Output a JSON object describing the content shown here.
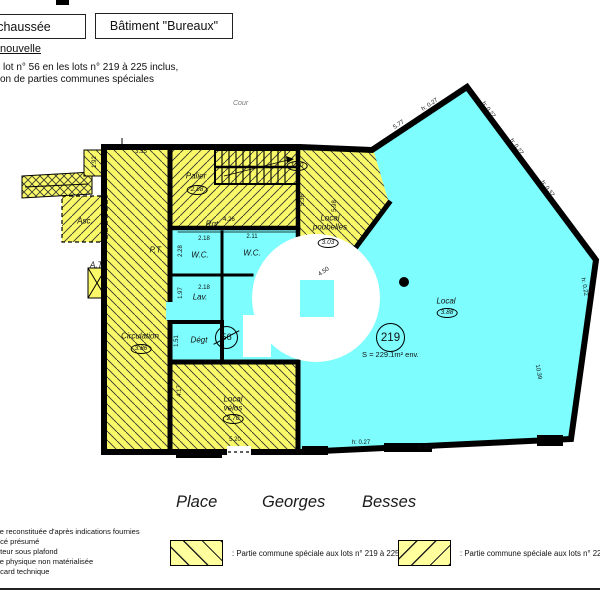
{
  "header": {
    "floor_box": "chaussée",
    "building_box": "Bâtiment \"Bureaux\"",
    "situation": "nouvelle",
    "line1": "lot n° 56 en les lots n° 219 à 225 inclus,",
    "line2": "on de parties communes spéciales"
  },
  "plan": {
    "cour": "Cour",
    "area": "S = 229.1m² env.",
    "lot_new": "219",
    "lot_old": "56",
    "rooms": [
      {
        "t": "Palier",
        "x": 196,
        "y": 176,
        "n": "room-label-palier"
      },
      {
        "t": "Rgt.",
        "x": 213,
        "y": 224,
        "n": "room-label-rgt"
      },
      {
        "t": "W.C.",
        "x": 200,
        "y": 255,
        "n": "room-label-wc-1"
      },
      {
        "t": "W.C.",
        "x": 252,
        "y": 253,
        "n": "room-label-wc-2"
      },
      {
        "t": "Lav.",
        "x": 200,
        "y": 297,
        "n": "room-label-lav"
      },
      {
        "t": "Dégt",
        "x": 199,
        "y": 340,
        "n": "room-label-degt"
      },
      {
        "t": "Circulation",
        "x": 140,
        "y": 336,
        "n": "room-label-circulation"
      },
      {
        "t": "Local",
        "x": 330,
        "y": 218,
        "n": "room-label-local-poubelles-1"
      },
      {
        "t": "poubelles",
        "x": 330,
        "y": 227,
        "n": "room-label-local-poubelles-2"
      },
      {
        "t": "Local",
        "x": 233,
        "y": 399,
        "n": "room-label-local-velos-1"
      },
      {
        "t": "vélos",
        "x": 233,
        "y": 408,
        "n": "room-label-local-velos-2"
      },
      {
        "t": "Local",
        "x": 446,
        "y": 301,
        "n": "room-label-local"
      },
      {
        "t": "Asc.",
        "x": 85,
        "y": 221,
        "n": "room-label-ascenseur"
      },
      {
        "t": "P.T.",
        "x": 156,
        "y": 250,
        "n": "room-label-pt"
      },
      {
        "t": "A.T.",
        "x": 97,
        "y": 265,
        "n": "room-label-at"
      }
    ],
    "ovals": [
      {
        "t": "2.88",
        "x": 197,
        "y": 190,
        "n": "height-oval-palier"
      },
      {
        "t": "1.90",
        "x": 297,
        "y": 166,
        "n": "height-oval-stairs"
      },
      {
        "t": "3.03",
        "x": 328,
        "y": 243,
        "n": "height-oval-poubelles"
      },
      {
        "t": "3.86",
        "x": 141,
        "y": 349,
        "n": "height-oval-circulation"
      },
      {
        "t": "2.70",
        "x": 233,
        "y": 419,
        "n": "height-oval-velos"
      },
      {
        "t": "3.88",
        "x": 447,
        "y": 313,
        "n": "height-oval-local"
      }
    ],
    "dims": [
      {
        "t": "3.55",
        "x": 141,
        "y": 152,
        "r": 0
      },
      {
        "t": "1.92",
        "x": 95,
        "y": 162,
        "r": -90
      },
      {
        "t": "4.26",
        "x": 229,
        "y": 220,
        "r": 0
      },
      {
        "t": "2.18",
        "x": 204,
        "y": 239,
        "r": 0
      },
      {
        "t": "2.11",
        "x": 252,
        "y": 237,
        "r": 0
      },
      {
        "t": "2.18",
        "x": 204,
        "y": 288,
        "r": 0
      },
      {
        "t": "2.28",
        "x": 181,
        "y": 251,
        "r": -90
      },
      {
        "t": "1.97",
        "x": 181,
        "y": 293,
        "r": -90
      },
      {
        "t": "1.51",
        "x": 177,
        "y": 341,
        "r": -90
      },
      {
        "t": "4.17",
        "x": 180,
        "y": 391,
        "r": -90
      },
      {
        "t": "5.20",
        "x": 235,
        "y": 440,
        "r": 0
      },
      {
        "t": "5.36",
        "x": 303,
        "y": 200,
        "r": -90
      },
      {
        "t": "5.98",
        "x": 335,
        "y": 206,
        "r": -90
      },
      {
        "t": "4.50",
        "x": 324,
        "y": 272,
        "r": -35
      },
      {
        "t": "5.77",
        "x": 399,
        "y": 125,
        "r": -33
      },
      {
        "t": "h: 0.27",
        "x": 430,
        "y": 105,
        "r": -33
      },
      {
        "t": "h: 0.27",
        "x": 488,
        "y": 110,
        "r": 53
      },
      {
        "t": "h: 0.27",
        "x": 516,
        "y": 147,
        "r": 53
      },
      {
        "t": "h: 0.37",
        "x": 547,
        "y": 189,
        "r": 53
      },
      {
        "t": "h: 0.27",
        "x": 573,
        "y": 231,
        "r": 53
      },
      {
        "t": "h: 0.22",
        "x": 584,
        "y": 287,
        "r": 80
      },
      {
        "t": "10.39",
        "x": 538,
        "y": 372,
        "r": 80
      },
      {
        "t": "h: 0.27",
        "x": 361,
        "y": 443,
        "r": 0
      },
      {
        "t": "h: 0.27",
        "x": 427,
        "y": 448,
        "r": 0
      }
    ]
  },
  "street": [
    "Place",
    "Georges",
    "Besses"
  ],
  "legend": {
    "notes": [
      "ite reconstituée d'après indications fournies",
      "acé présumé",
      "uteur sous plafond",
      "ite physique non matérialisée",
      "acard technique"
    ],
    "items": [
      {
        "label": ": Partie commune spéciale aux lots n° 219 à 225 inclus"
      },
      {
        "label": ": Partie commune spéciale aux lots n° 220 à 225 inclus"
      }
    ]
  },
  "colors": {
    "cyan": "#7dfdfd",
    "yellow": "#f8f868",
    "legend_yellow": "#ffff9e",
    "wall": "#000000"
  }
}
